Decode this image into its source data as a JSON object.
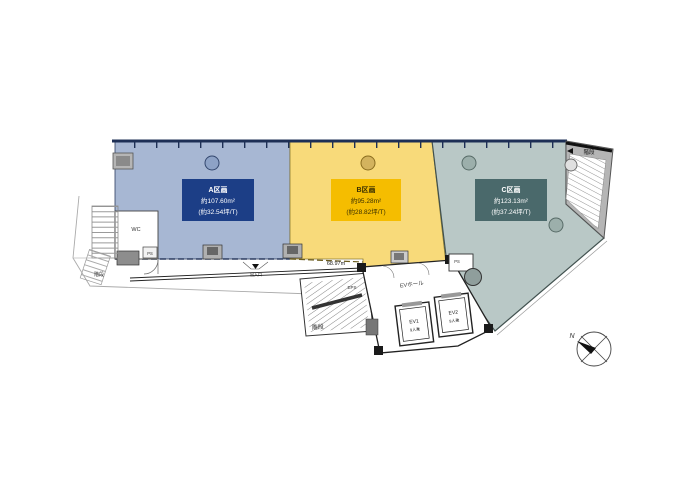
{
  "page": {
    "background": "#ffffff"
  },
  "floor_plan": {
    "units": [
      {
        "id": "A",
        "name": "A区画",
        "area": "約107.60m²",
        "tsubo": "(約32.54坪/T)",
        "fill": "#a7b7d3",
        "label_bg": "#1c3e86",
        "label_text": "#ffffff"
      },
      {
        "id": "B",
        "name": "B区画",
        "area": "約95.28m²",
        "tsubo": "(約28.82坪/T)",
        "fill": "#f8da7a",
        "label_bg": "#f5bd00",
        "label_text": "#3a3000"
      },
      {
        "id": "C",
        "name": "C区画",
        "area": "約123.13m²",
        "tsubo": "(約37.24坪/T)",
        "fill": "#b9c8c6",
        "label_bg": "#4a696b",
        "label_text": "#ffffff"
      }
    ],
    "labels": {
      "stair_top_right": "階段",
      "stair_bottom": "階段",
      "stair_left": "階段",
      "ev_hall": "EVホール",
      "ev1": "EV1",
      "ev1_capacity": "9人乗",
      "ev2": "EV2",
      "ev2_capacity": "9人乗",
      "ps1": "PS",
      "ps2": "PS",
      "wc": "WC",
      "eps": "EPS",
      "dimension": "68.97m",
      "entrance": "出入口",
      "compass_north": "N"
    }
  }
}
